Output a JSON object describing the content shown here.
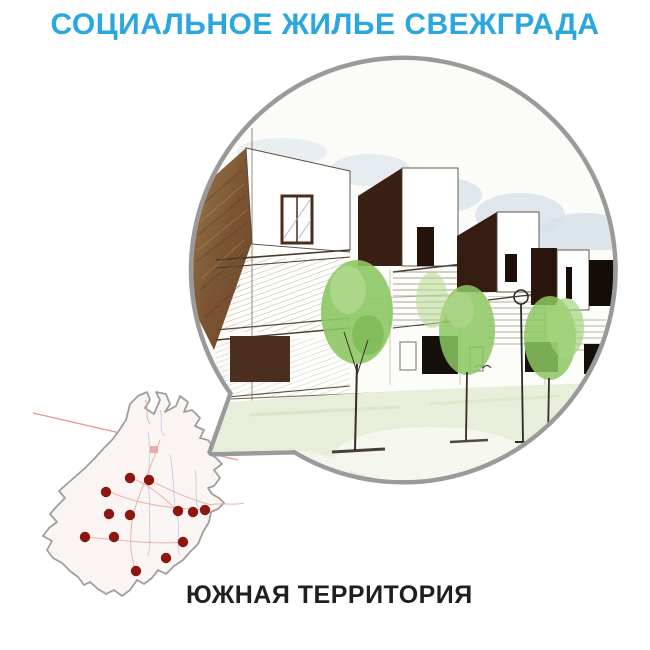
{
  "header": {
    "title": "СОЦИАЛЬНОЕ ЖИЛЬЕ СВЕЖГРАДА",
    "color": "#2AA7DF"
  },
  "bubble": {
    "icon": "speech-bubble-callout",
    "border_color": "#9a9a9a",
    "fill": "#fcfcfa",
    "content": "architectural-sketch-of-social-housing-row"
  },
  "sketch_palette": {
    "tree_green": "#8cc763",
    "ground_green": "#e7eed9",
    "sky_wash": "#d8e1ea",
    "brick_brown": "#8a6a42",
    "ink_dark": "#241309"
  },
  "map": {
    "name": "southern-territory-map",
    "label": "ЮЖНАЯ ТЕРРИТОРИЯ",
    "label_color": "#1f1f1f",
    "outline_color": "#9e9e9e",
    "fill_color": "#faf5f3",
    "road_color": "#e6aca4",
    "stream_color": "#b4bce4",
    "dot_color": "#8B170F",
    "dot_radius": 5.2,
    "dots": [
      {
        "x": 130,
        "y": 478
      },
      {
        "x": 149,
        "y": 480
      },
      {
        "x": 106,
        "y": 492
      },
      {
        "x": 109,
        "y": 514
      },
      {
        "x": 130,
        "y": 515
      },
      {
        "x": 178,
        "y": 511
      },
      {
        "x": 193,
        "y": 512
      },
      {
        "x": 205,
        "y": 510
      },
      {
        "x": 85,
        "y": 537
      },
      {
        "x": 114,
        "y": 537
      },
      {
        "x": 183,
        "y": 542
      },
      {
        "x": 166,
        "y": 558
      },
      {
        "x": 136,
        "y": 571
      }
    ]
  }
}
